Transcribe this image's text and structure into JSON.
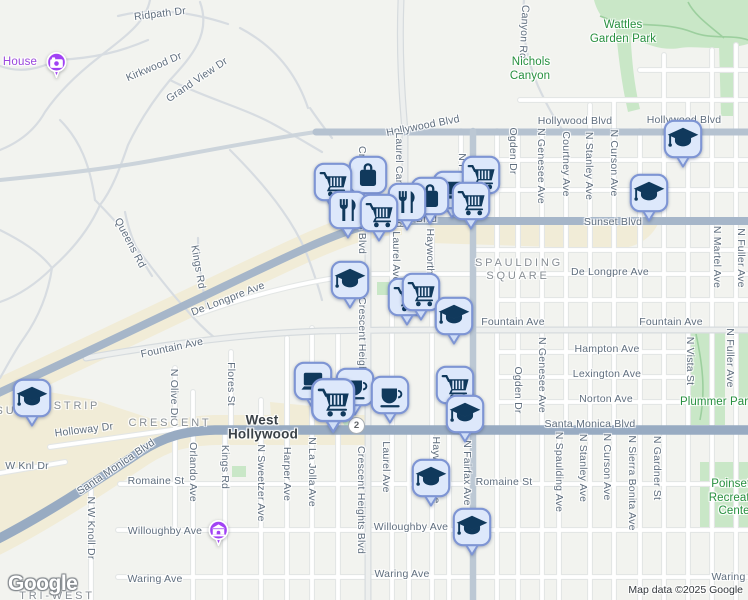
{
  "map": {
    "logo": "Google",
    "attribution": "Map data ©2025 Google",
    "route_shield": {
      "label": "2"
    },
    "colors": {
      "marker_fill": "#dde8fb",
      "marker_border": "#7e95d4",
      "marker_glyph": "#10395c",
      "poi_purple": "#a142f4",
      "park_green": "#c9e7c7",
      "park_label_green": "#27903f",
      "road_major_slate": "#98abc2",
      "corridor_beige": "#f1ecd7",
      "district_gray": "#878e94",
      "street_gray": "#5f6e7e",
      "city_dark": "#3a4147"
    },
    "marker_icons": {
      "cart": "shopping-cart-icon",
      "bag": "shopping-bag-icon",
      "restaurant": "restaurant-icon",
      "cup": "coffee-cup-icon",
      "laptop": "laptop-icon",
      "grad": "school-icon",
      "camera": "camera-icon",
      "museum": "museum-icon"
    },
    "labels": [
      {
        "t": "Ridpath Dr",
        "x": 160,
        "y": 14,
        "r": -7
      },
      {
        "t": "Kirkwood Dr",
        "x": 154,
        "y": 67,
        "r": -23
      },
      {
        "t": "Grand View Dr",
        "x": 197,
        "y": 80,
        "r": -34
      },
      {
        "t": "Hollywood Blvd",
        "x": 423,
        "y": 126,
        "r": -11
      },
      {
        "t": "Hollywood Blvd",
        "x": 575,
        "y": 121
      },
      {
        "t": "Hollywood Blvd",
        "x": 684,
        "y": 120
      },
      {
        "t": "Canyon Rd",
        "x": 524,
        "y": 32,
        "r": 93
      },
      {
        "t": "Sunset Blvd",
        "x": 408,
        "y": 219
      },
      {
        "t": "Sunset Blvd",
        "x": 613,
        "y": 222
      },
      {
        "t": "De Longpre Ave",
        "x": 228,
        "y": 299,
        "r": -21
      },
      {
        "t": "De Longpre Ave",
        "x": 610,
        "y": 272
      },
      {
        "t": "Fountain Ave",
        "x": 172,
        "y": 348,
        "r": -12
      },
      {
        "t": "Fountain Ave",
        "x": 513,
        "y": 322
      },
      {
        "t": "Fountain Ave",
        "x": 671,
        "y": 322
      },
      {
        "t": "Hampton Ave",
        "x": 607,
        "y": 349
      },
      {
        "t": "Lexington Ave",
        "x": 607,
        "y": 374
      },
      {
        "t": "Norton Ave",
        "x": 606,
        "y": 399
      },
      {
        "t": "Santa Monica Blvd",
        "x": 116,
        "y": 467,
        "r": -34
      },
      {
        "t": "Santa Monica Blvd",
        "x": 590,
        "y": 424
      },
      {
        "t": "Holloway Dr",
        "x": 84,
        "y": 430,
        "r": -7
      },
      {
        "t": "W Knl Dr",
        "x": 27,
        "y": 466
      },
      {
        "t": "Romaine St",
        "x": 156,
        "y": 481
      },
      {
        "t": "Romaine St",
        "x": 504,
        "y": 482
      },
      {
        "t": "Willoughby Ave",
        "x": 165,
        "y": 531
      },
      {
        "t": "Willoughby Ave",
        "x": 411,
        "y": 527
      },
      {
        "t": "Waring Ave",
        "x": 155,
        "y": 579
      },
      {
        "t": "Waring Ave",
        "x": 402,
        "y": 574
      },
      {
        "t": "Waring Ave",
        "x": 739,
        "y": 577
      },
      {
        "t": "Queens Rd",
        "x": 130,
        "y": 243,
        "r": 62
      },
      {
        "t": "Kings Rd",
        "x": 198,
        "y": 267,
        "r": 80
      },
      {
        "t": "Ogden Dr",
        "x": 513,
        "y": 151,
        "r": 90
      },
      {
        "t": "N Genesee Ave",
        "x": 541,
        "y": 166,
        "r": 90
      },
      {
        "t": "Courtney Ave",
        "x": 566,
        "y": 164,
        "r": 90
      },
      {
        "t": "N Stanley Ave",
        "x": 589,
        "y": 166,
        "r": 90
      },
      {
        "t": "N Curson Ave",
        "x": 614,
        "y": 163,
        "r": 90
      },
      {
        "t": "N Fairfax Ave",
        "x": 462,
        "y": 186,
        "r": 90
      },
      {
        "t": "Laurel Canyon Blvd",
        "x": 399,
        "y": 180,
        "r": 90
      },
      {
        "t": "N Martel Ave",
        "x": 717,
        "y": 257,
        "r": 90
      },
      {
        "t": "N Fuller Ave",
        "x": 741,
        "y": 258,
        "r": 90
      },
      {
        "t": "Crescent Heights Blvd",
        "x": 362,
        "y": 200,
        "r": 90
      },
      {
        "t": "Crescent Heights Blvd",
        "x": 362,
        "y": 351,
        "r": 90
      },
      {
        "t": "Laurel Ave",
        "x": 396,
        "y": 257,
        "r": 90
      },
      {
        "t": "Hayworth Ave",
        "x": 430,
        "y": 262,
        "r": 90
      },
      {
        "t": "Ogden Dr",
        "x": 518,
        "y": 390,
        "r": 90
      },
      {
        "t": "N Genesee Ave",
        "x": 542,
        "y": 375,
        "r": 90
      },
      {
        "t": "N Vista St",
        "x": 690,
        "y": 361,
        "r": 90
      },
      {
        "t": "N Fuller Ave",
        "x": 730,
        "y": 358,
        "r": 90
      },
      {
        "t": "N Olive Dr",
        "x": 174,
        "y": 394,
        "r": 90
      },
      {
        "t": "Flores St",
        "x": 231,
        "y": 384,
        "r": 90
      },
      {
        "t": "Orlando Ave",
        "x": 193,
        "y": 472,
        "r": 90
      },
      {
        "t": "Kings Rd",
        "x": 225,
        "y": 467,
        "r": 90
      },
      {
        "t": "N Sweetzer Ave",
        "x": 261,
        "y": 483,
        "r": 90
      },
      {
        "t": "Harper Ave",
        "x": 287,
        "y": 474,
        "r": 90
      },
      {
        "t": "N La Jolla Ave",
        "x": 312,
        "y": 472,
        "r": 90
      },
      {
        "t": "Crescent Heights Blvd",
        "x": 361,
        "y": 500,
        "r": 90
      },
      {
        "t": "Laurel Ave",
        "x": 386,
        "y": 467,
        "r": 90
      },
      {
        "t": "Hayworth Ave",
        "x": 436,
        "y": 470,
        "r": 90
      },
      {
        "t": "N Fairfax Ave",
        "x": 467,
        "y": 473,
        "r": 90
      },
      {
        "t": "N W Knoll Dr",
        "x": 91,
        "y": 528,
        "r": 90
      },
      {
        "t": "N Spaulding Ave",
        "x": 559,
        "y": 472,
        "r": 90
      },
      {
        "t": "N Stanley Ave",
        "x": 583,
        "y": 468,
        "r": 90
      },
      {
        "t": "N Curson Ave",
        "x": 607,
        "y": 467,
        "r": 90
      },
      {
        "t": "N Sierra Bonita Ave",
        "x": 632,
        "y": 483,
        "r": 90
      },
      {
        "t": "N Gardner St",
        "x": 657,
        "y": 468,
        "r": 90
      },
      {
        "t": "SPAULDING",
        "x": 519,
        "y": 263,
        "c": "di"
      },
      {
        "t": "SQUARE",
        "x": 518,
        "y": 276,
        "c": "di"
      },
      {
        "t": "CRESCENT",
        "x": 170,
        "y": 423,
        "c": "di"
      },
      {
        "t": "SU",
        "x": 6,
        "y": 411,
        "c": "di"
      },
      {
        "t": "STRIP",
        "x": 77,
        "y": 406,
        "c": "di"
      },
      {
        "t": "TRI-WEST",
        "x": 57,
        "y": 596,
        "c": "di"
      },
      {
        "t": "West",
        "x": 262,
        "y": 420,
        "c": "ci"
      },
      {
        "t": "Hollywood",
        "x": 263,
        "y": 434,
        "c": "ci"
      },
      {
        "t": "Wattles",
        "x": 623,
        "y": 25,
        "c": "pk"
      },
      {
        "t": "Garden Park",
        "x": 623,
        "y": 39,
        "c": "pk"
      },
      {
        "t": "Nichols",
        "x": 531,
        "y": 62,
        "c": "pk"
      },
      {
        "t": "Canyon",
        "x": 530,
        "y": 76,
        "c": "pk"
      },
      {
        "t": "Plummer Park",
        "x": 717,
        "y": 402,
        "c": "pk"
      },
      {
        "t": "Poinsettia",
        "x": 737,
        "y": 484,
        "c": "pk"
      },
      {
        "t": "Recreation",
        "x": 737,
        "y": 498,
        "c": "pk"
      },
      {
        "t": "Center",
        "x": 736,
        "y": 511,
        "c": "pk"
      },
      {
        "t": "House",
        "x": 20,
        "y": 62,
        "c": "poi"
      }
    ],
    "markers": [
      {
        "type": "bag",
        "x": 368,
        "y": 175
      },
      {
        "type": "laptop",
        "x": 452,
        "y": 190
      },
      {
        "type": "cart",
        "x": 481,
        "y": 175
      },
      {
        "type": "cart",
        "x": 333,
        "y": 182
      },
      {
        "type": "bag",
        "x": 430,
        "y": 196
      },
      {
        "type": "restaurant",
        "x": 407,
        "y": 202
      },
      {
        "type": "cart",
        "x": 471,
        "y": 201
      },
      {
        "type": "restaurant",
        "x": 348,
        "y": 210
      },
      {
        "type": "cart",
        "x": 379,
        "y": 213
      },
      {
        "type": "grad",
        "x": 683,
        "y": 139
      },
      {
        "type": "grad",
        "x": 649,
        "y": 193
      },
      {
        "type": "grad",
        "x": 350,
        "y": 280
      },
      {
        "type": "cart",
        "x": 407,
        "y": 297
      },
      {
        "type": "cart",
        "x": 421,
        "y": 292
      },
      {
        "type": "grad",
        "x": 454,
        "y": 316
      },
      {
        "type": "laptop",
        "x": 313,
        "y": 381
      },
      {
        "type": "cup",
        "x": 355,
        "y": 387
      },
      {
        "type": "cart",
        "x": 333,
        "y": 400,
        "s": 1.15
      },
      {
        "type": "cup",
        "x": 390,
        "y": 395
      },
      {
        "type": "cart",
        "x": 455,
        "y": 385
      },
      {
        "type": "grad",
        "x": 465,
        "y": 414
      },
      {
        "type": "grad",
        "x": 32,
        "y": 398
      },
      {
        "type": "grad",
        "x": 431,
        "y": 478
      },
      {
        "type": "grad",
        "x": 472,
        "y": 527
      }
    ],
    "poi_pins": [
      {
        "icon": "camera",
        "x": 56,
        "y": 62
      },
      {
        "icon": "museum",
        "x": 218,
        "y": 530
      }
    ]
  }
}
